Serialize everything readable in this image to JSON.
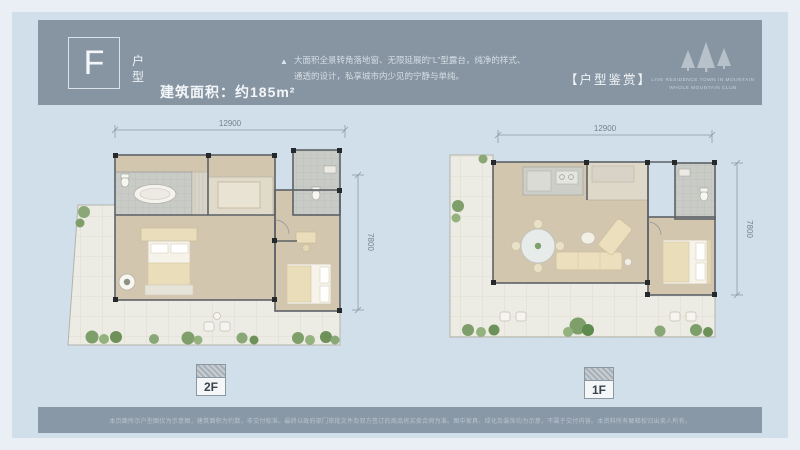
{
  "header": {
    "unit_letter": "F",
    "unit_type_top": "户",
    "unit_type_bottom": "型",
    "area_label": "建筑面积：约185m²",
    "bullet": "▲",
    "description_line1": "大面积全景转角落地窗、无限延展的“L”型露台，纯净的样式、",
    "description_line2": "通透的设计，私享城市内少见的宁静与单纯。",
    "section_tag": "【户型鉴赏】",
    "logo": {
      "icon": "pine-trees-icon",
      "tagline_line1": "LIVE RESIDENCE TOWN IN MOUNTAIN",
      "tagline_line2": "WHOLE MOUNTAIN CLUB"
    }
  },
  "plans": {
    "left": {
      "floor_label": "2F",
      "width_dim": "12900",
      "height_dim": "7800"
    },
    "right": {
      "floor_label": "1F",
      "width_dim": "12900",
      "height_dim": "7800"
    }
  },
  "footer": {
    "disclaimer": "本页面所示户型图仅为示意图，建筑面积为约数，非交付标准。最终以政府部门审批文件及双方签订的商品房买卖合同为准。图中家具、绿化及装饰均为示意，不属于交付内容。本资料所有解释权归出卖人所有。"
  },
  "colors": {
    "band": "#8795a3",
    "background": "#d0dfe9",
    "floor_tan": "#d3c6ae",
    "terrace": "#ecebe4",
    "plant_green": "#7e9f6a"
  }
}
